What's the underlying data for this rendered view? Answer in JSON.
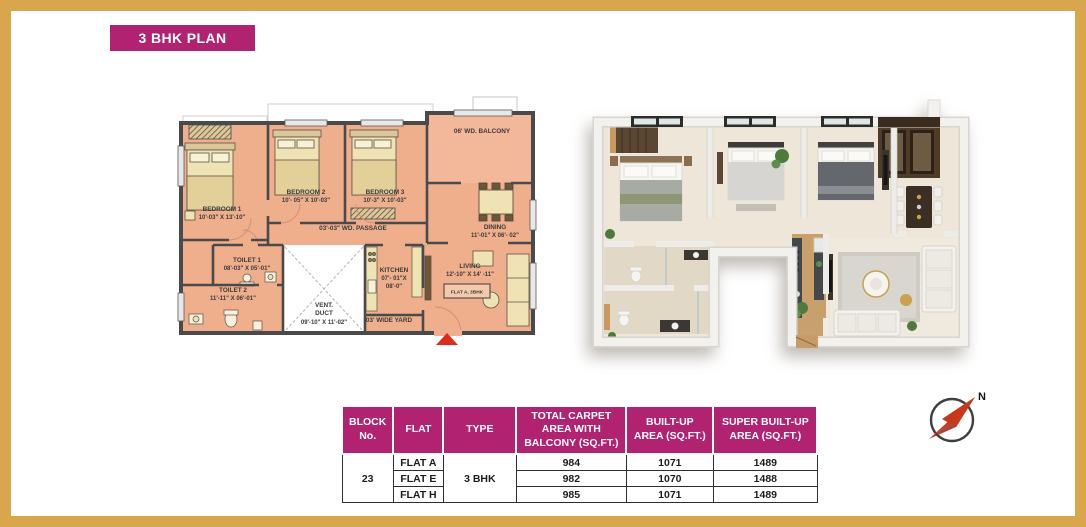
{
  "page": {
    "border_color": "#D9A74B",
    "background": "#FFFFFF"
  },
  "title": {
    "label": "3 BHK PLAN"
  },
  "colors": {
    "accent": "#B12371",
    "gold": "#D9A74B",
    "floor_2d": "#EFAE8C",
    "wall_2d": "#4A4A4A",
    "marker_red": "#E02A17"
  },
  "plan2d": {
    "bedroom1": {
      "name": "BEDROOM 1",
      "dims": "10'-03\" X 13'-10\""
    },
    "bedroom2": {
      "name": "BEDROOM 2",
      "dims": "10'- 05\" X 10'-03\""
    },
    "bedroom3": {
      "name": "BEDROOM 3",
      "dims": "10'-3\" X 10'-03\""
    },
    "balcony": {
      "name": "06' WD. BALCONY"
    },
    "dining": {
      "name": "DINING",
      "dims": "11'-01\" X 06'- 02\""
    },
    "passage": {
      "name": "03'-03\" WD. PASSAGE"
    },
    "toilet1": {
      "name": "TOILET 1",
      "dims": "08'-03\" X 05'-01\""
    },
    "toilet2": {
      "name": "TOILET 2",
      "dims": "11'-11\" X 06'-01\""
    },
    "vent": {
      "l1": "VENT.",
      "l2": "DUCT",
      "dims": "09'-10\" X 11'-02\""
    },
    "kitchen": {
      "l1": "KITCHEN",
      "l2": "07'- 01\"X",
      "l3": "08'-0\""
    },
    "yard": {
      "name": "03' WIDE YARD"
    },
    "living": {
      "name": "LIVING",
      "dims": "12'-10\" X 14' -11\""
    },
    "flat_tag": "FLAT A, 3BHK"
  },
  "table": {
    "headers": [
      "BLOCK No.",
      "FLAT",
      "TYPE",
      "TOTAL CARPET AREA WITH  BALCONY (SQ.FT.)",
      "BUILT-UP AREA (SQ.FT.)",
      "SUPER BUILT-UP AREA (SQ.FT.)"
    ],
    "block_no": "23",
    "type_value": "3 BHK",
    "rows": [
      {
        "flat": "FLAT A",
        "carpet": "984",
        "builtup": "1071",
        "super": "1489"
      },
      {
        "flat": "FLAT E",
        "carpet": "982",
        "builtup": "1070",
        "super": "1488"
      },
      {
        "flat": "FLAT H",
        "carpet": "985",
        "builtup": "1071",
        "super": "1489"
      }
    ]
  },
  "compass": {
    "label": "N"
  }
}
